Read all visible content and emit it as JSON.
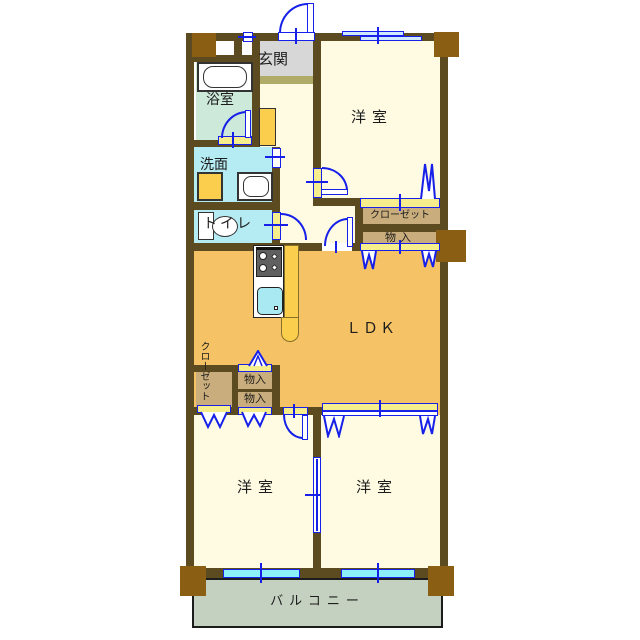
{
  "meta": {
    "type": "japanese-apartment-floor-plan",
    "language": "ja"
  },
  "palette": {
    "wall": "#5c4a21",
    "pillar": "#8a5e13",
    "room_cream": "#fffbe3",
    "ldk_orange": "#f5c365",
    "bath_mint": "#cde9da",
    "water_cyan": "#b5ebf3",
    "genkan_gray": "#d7d7d7",
    "step_olive": "#b1ab69",
    "balcony_green": "#c4d1c1",
    "closet_tan": "#c9ad7c",
    "sill_yellow": "#f6ee8d",
    "counter_yellow": "#fbce4d",
    "line_blue": "#1620e8",
    "window_cyan": "#8cf0fb",
    "sink_cyan": "#a9e9f1",
    "stove_gray": "#606060"
  },
  "rooms": {
    "genkan": {
      "label": "玄関"
    },
    "bathroom": {
      "label": "浴室"
    },
    "washroom": {
      "label": "洗面"
    },
    "toilet": {
      "label": "トイレ"
    },
    "bedroom_top": {
      "label": "洋室"
    },
    "closet_right": {
      "label": "クローゼット"
    },
    "storage_right": {
      "label": "物入"
    },
    "ldk": {
      "label": "ＬＤＫ"
    },
    "closet_left": {
      "label": "クローゼット"
    },
    "storage_upper": {
      "label": "物入"
    },
    "storage_lower": {
      "label": "物入"
    },
    "bedroom_bottom_left": {
      "label": "洋室"
    },
    "bedroom_bottom_right": {
      "label": "洋室"
    },
    "balcony": {
      "label": "バルコニー"
    }
  },
  "symbols": {
    "swing_door": "quarter-arc door symbol",
    "folding_door": "blue zigzag folding-door symbol",
    "sliding_window": "blue double-line sliding window",
    "fixtures": [
      "bathtub",
      "washbasin",
      "washing-machine",
      "toilet",
      "gas-stove",
      "kitchen-sink"
    ]
  }
}
